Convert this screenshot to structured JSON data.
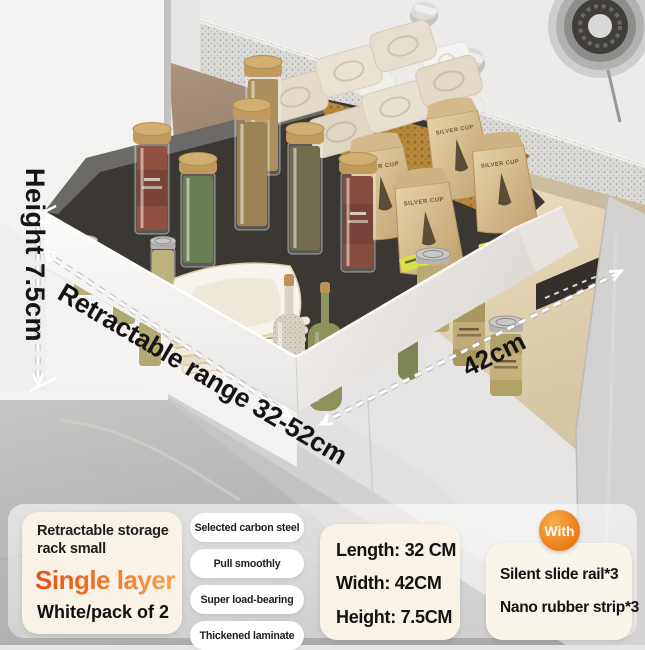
{
  "annotations": {
    "height": "Height 7.5cm",
    "range": "Retractable range 32-52cm",
    "width": "42cm"
  },
  "scene": {
    "bag_brand": "SILVER CUP"
  },
  "panel": {
    "product": {
      "title": "Retractable storage rack small",
      "highlight": "Single layer",
      "variant": "White/pack of 2"
    },
    "features": [
      "Selected carbon steel",
      "Pull smoothly",
      "Super load-bearing",
      "Thickened laminate"
    ],
    "dimensions": [
      "Length: 32 CM",
      "Width: 42CM",
      "Height: 7.5CM"
    ],
    "included": {
      "badge": "With",
      "items": [
        "Silent slide rail*3",
        "Nano rubber strip*3"
      ]
    }
  },
  "colors": {
    "accent_orange": "#ee7b1e",
    "highlight_gradient": [
      "#e4541b",
      "#f7a34f"
    ],
    "card_cream": "#f8f2e7",
    "pill_white": "#ffffff"
  }
}
